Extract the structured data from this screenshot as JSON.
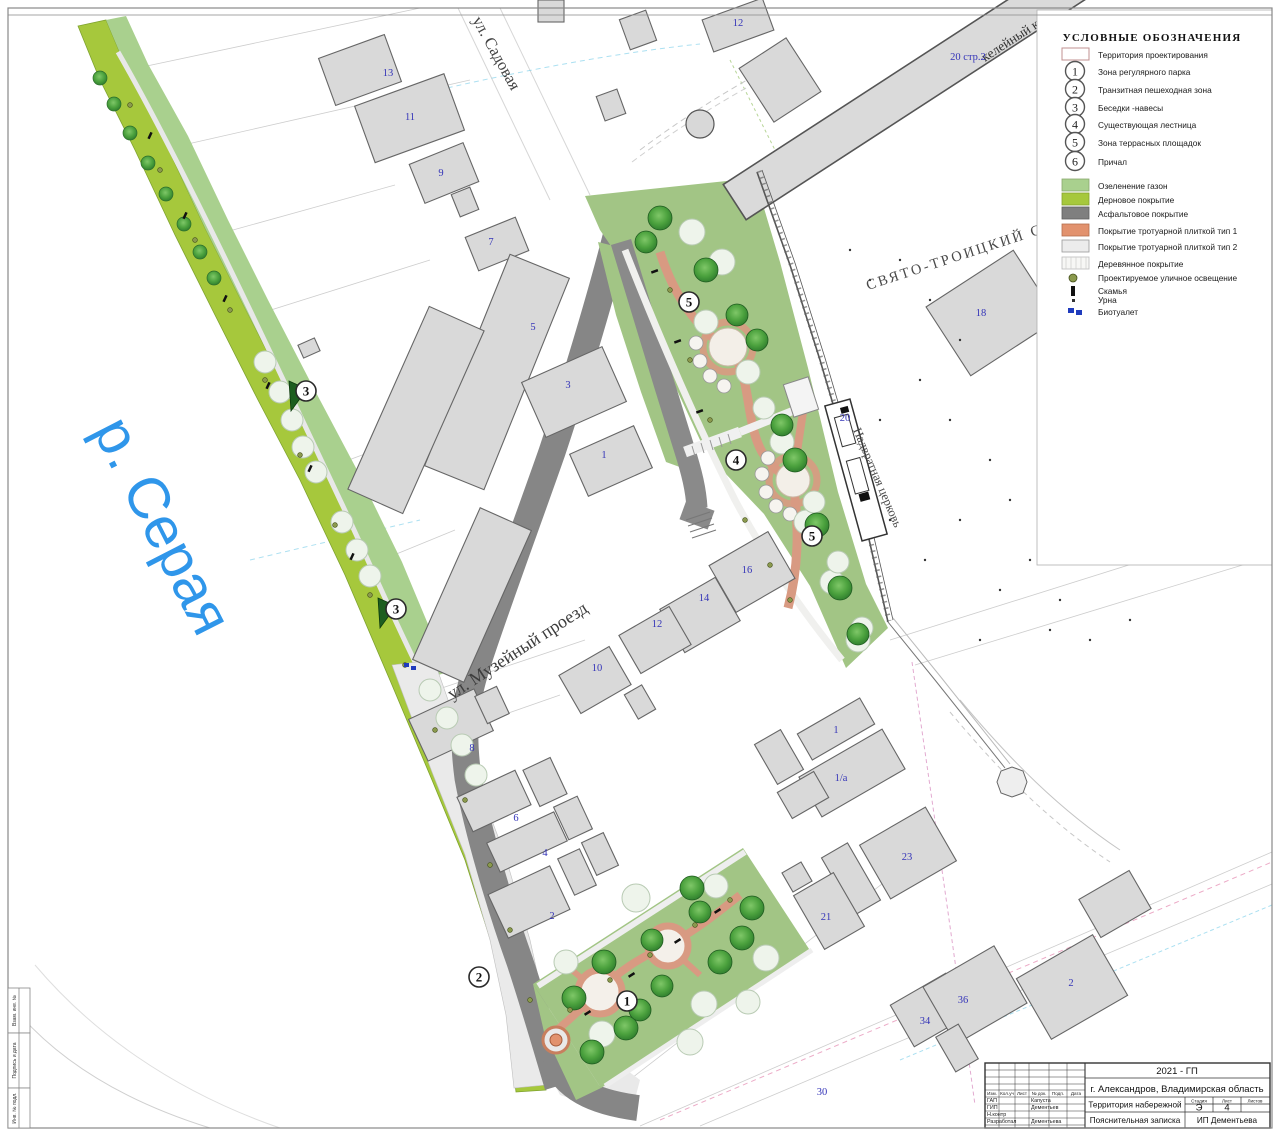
{
  "sheet": {
    "frame_labels": [
      {
        "label": "Взам. инв. №"
      },
      {
        "label": "Подпись и дата"
      },
      {
        "label": "Инв. № подл."
      }
    ]
  },
  "map": {
    "river_label": "р. Серая",
    "street_labels": {
      "sadovaya": "ул. Садовая",
      "muzeiny": "ул. Музейный проезд"
    },
    "landmark_labels": {
      "cathedral": "СВЯТО-ТРОИЦКИЙ СОБОР",
      "gate_church": "Надвратная церковь",
      "monastery_building": "келейный к"
    },
    "building_labels": [
      {
        "t": "12"
      },
      {
        "t": "13"
      },
      {
        "t": "11"
      },
      {
        "t": "9"
      },
      {
        "t": "7"
      },
      {
        "t": "5"
      },
      {
        "t": "3"
      },
      {
        "t": "1"
      },
      {
        "t": "18"
      },
      {
        "t": "20"
      },
      {
        "t": "20 стр.2"
      },
      {
        "t": "10"
      },
      {
        "t": "12"
      },
      {
        "t": "14"
      },
      {
        "t": "16"
      },
      {
        "t": "8"
      },
      {
        "t": "6"
      },
      {
        "t": "4"
      },
      {
        "t": "2"
      },
      {
        "t": "1"
      },
      {
        "t": "1/a"
      },
      {
        "t": "23"
      },
      {
        "t": "21"
      },
      {
        "t": "34"
      },
      {
        "t": "36"
      },
      {
        "t": "2"
      },
      {
        "t": "30"
      }
    ],
    "zone_markers": [
      {
        "n": "3"
      },
      {
        "n": "3"
      },
      {
        "n": "2"
      },
      {
        "n": "1"
      },
      {
        "n": "4"
      },
      {
        "n": "5"
      },
      {
        "n": "5"
      }
    ]
  },
  "legend": {
    "title": "УСЛОВНЫЕ ОБОЗНАЧЕНИЯ",
    "territory": {
      "label": "Территория проектирования"
    },
    "zones": [
      {
        "num": "1",
        "label": "Зона регулярного парка"
      },
      {
        "num": "2",
        "label": "Транзитная пешеходная зона"
      },
      {
        "num": "3",
        "label": "Беседки -навесы"
      },
      {
        "num": "4",
        "label": "Существующая лестница"
      },
      {
        "num": "5",
        "label": "Зона террасных площадок"
      },
      {
        "num": "6",
        "label": "Причал"
      }
    ],
    "surfaces": [
      {
        "label": "Озеленение газон",
        "color": "#a9d08e"
      },
      {
        "label": "Дерновое покрытие",
        "color": "#a6c83c"
      },
      {
        "label": "Асфальтовое покрытие",
        "color": "#7f7f7f"
      },
      {
        "label": "Покрытие тротуарной плиткой тип 1",
        "color": "#e2926e"
      },
      {
        "label": "Покрытие тротуарной плиткой тип 2",
        "color": "#ececec"
      },
      {
        "label": "Деревянное покрытие",
        "color": "#f7f7f5"
      }
    ],
    "symbols": [
      {
        "label": "Проектируемое уличное освещение"
      },
      {
        "label": "Скамья"
      },
      {
        "label": "Урна"
      },
      {
        "label": "Биотуалет"
      }
    ]
  },
  "title_block": {
    "code": "2021 - ГП",
    "city": "г. Александров, Владимирская область",
    "project": "Территория набережной",
    "doc_type": "Пояснительная записка",
    "company": "ИП Дементьева",
    "stage_label": "Стадия",
    "sheet_label": "Лист",
    "sheets_label": "Листов",
    "stage": "Э",
    "sheet": "4",
    "header_cols": [
      {
        "label": "Изм."
      },
      {
        "label": "Кол.уч"
      },
      {
        "label": "Лист"
      },
      {
        "label": "№ док."
      },
      {
        "label": "Подп."
      },
      {
        "label": "Дата"
      }
    ],
    "roles": [
      {
        "role": "ГАП",
        "name": "Капуста"
      },
      {
        "role": "ГИП",
        "name": "Дементьев"
      },
      {
        "role": "Н.контр",
        "name": ""
      },
      {
        "role": "Разработал",
        "name": "Дементьева"
      }
    ]
  }
}
